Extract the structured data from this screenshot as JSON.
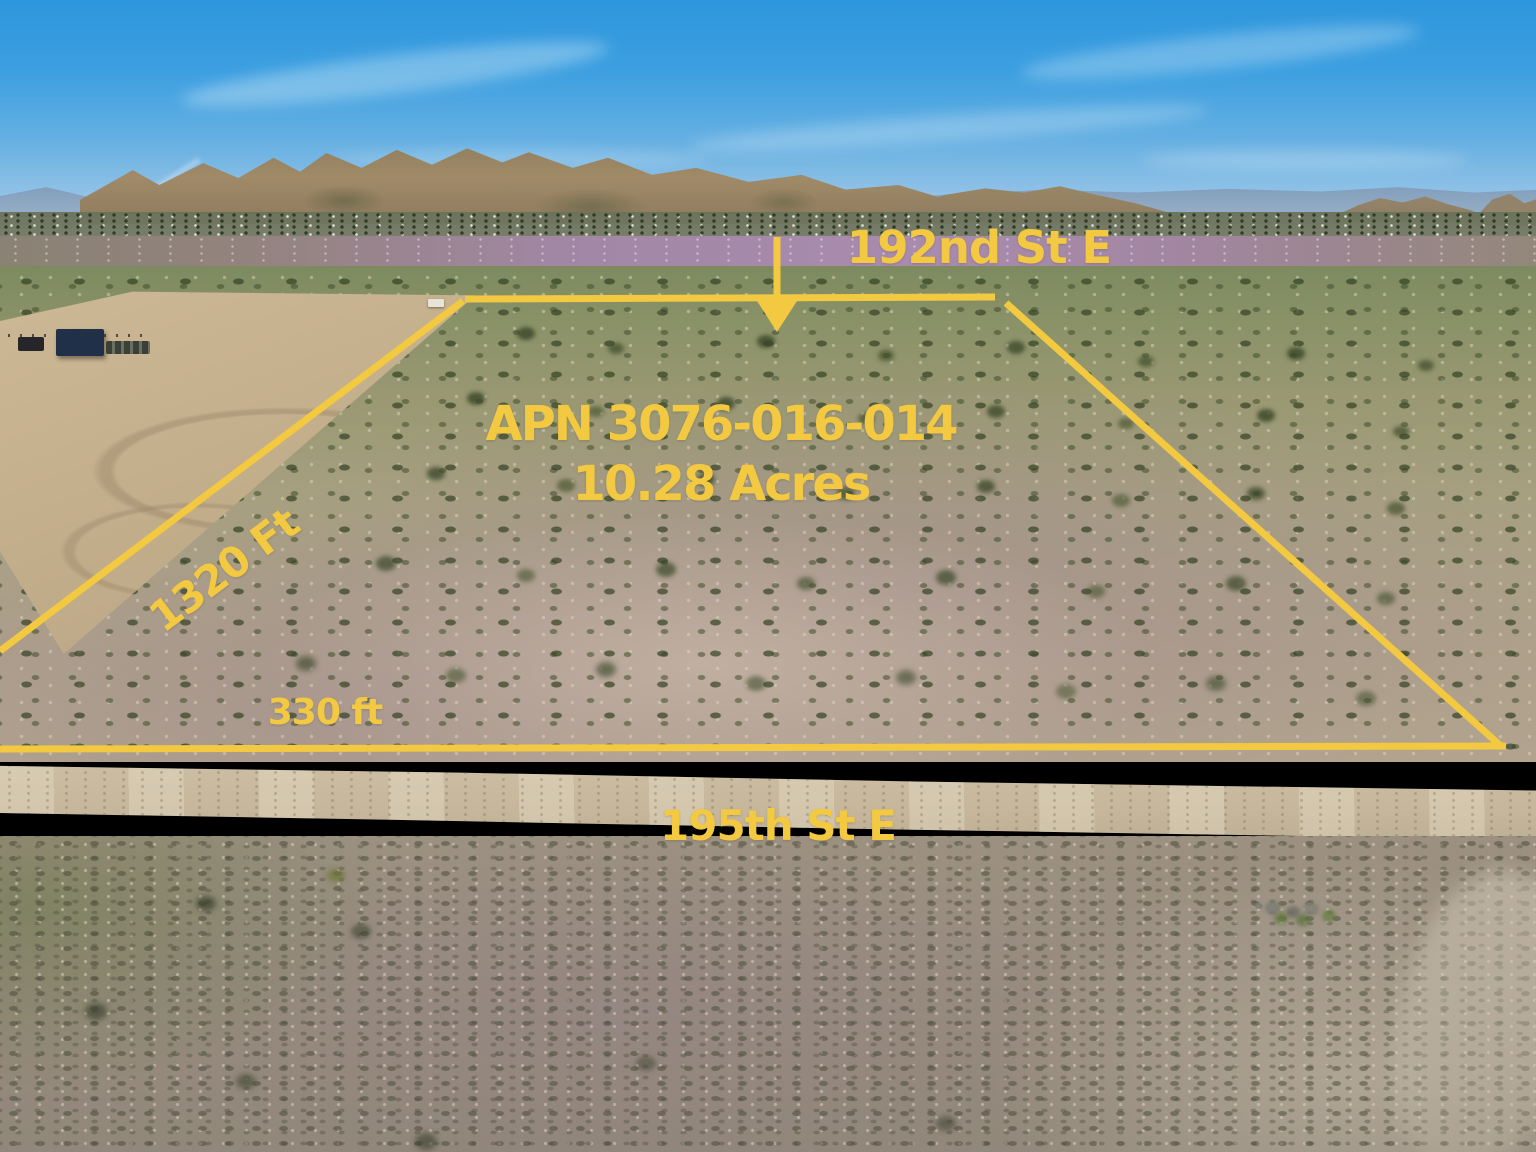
{
  "annotations": {
    "accent_color": "#F2C940",
    "top_street_label": "192nd St E",
    "apn_label": "APN 3076-016-014",
    "area_label": "10.28 Acres",
    "west_dimension_label": "1320 Ft",
    "south_dimension_label": "330 ft",
    "bottom_street_label": "195th St E"
  }
}
